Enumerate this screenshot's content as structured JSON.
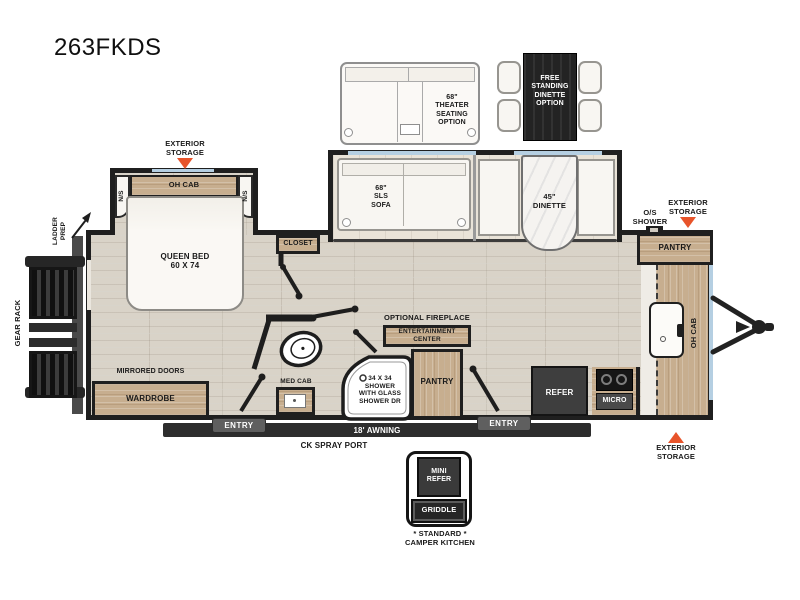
{
  "title": "263FKDS",
  "colors": {
    "accent_orange": "#e8542a",
    "wall": "#1f1f1f",
    "wood": "#c7ae8f",
    "window_blue": "#b5cfe2"
  },
  "options": {
    "theater_seating": "68\"\nTHEATER\nSEATING\nOPTION",
    "free_standing_dinette": "FREE\nSTANDING\nDINETTE\nOPTION"
  },
  "exterior": {
    "storage_bedroom": "EXTERIOR\nSTORAGE",
    "storage_front_top": "EXTERIOR\nSTORAGE",
    "storage_front_bottom": "EXTERIOR\nSTORAGE",
    "os_shower": "O/S\nSHOWER",
    "ladder_prep": "LADDER\nPREP",
    "gear_rack": "GEAR RACK",
    "awning": "18' AWNING",
    "ck_spray_port": "CK SPRAY PORT",
    "entry": "ENTRY"
  },
  "bedroom": {
    "oh_cab": "OH CAB",
    "ns_left": "N/S",
    "ns_right": "N/S",
    "queen_bed": "QUEEN BED\n60 X 74",
    "closet": "CLOSET",
    "mirrored_doors": "MIRRORED DOORS",
    "wardrobe": "WARDROBE"
  },
  "bath": {
    "med_cab": "MED CAB",
    "shower": "34 X 34\nSHOWER\nWITH GLASS\nSHOWER DR",
    "pantry": "PANTRY"
  },
  "living": {
    "sofa": "68\"\nSLS\nSOFA",
    "dinette": "45\"\nDINETTE",
    "optional_fireplace": "OPTIONAL FIREPLACE",
    "entertainment_center": "ENTERTAINMENT\nCENTER"
  },
  "kitchen": {
    "refer": "REFER",
    "micro": "MICRO",
    "pantry": "PANTRY",
    "oh_cab": "OH CAB"
  },
  "camper_kitchen": {
    "mini_refer": "MINI\nREFER",
    "griddle": "GRIDDLE",
    "caption": "* STANDARD *\nCAMPER KITCHEN"
  }
}
